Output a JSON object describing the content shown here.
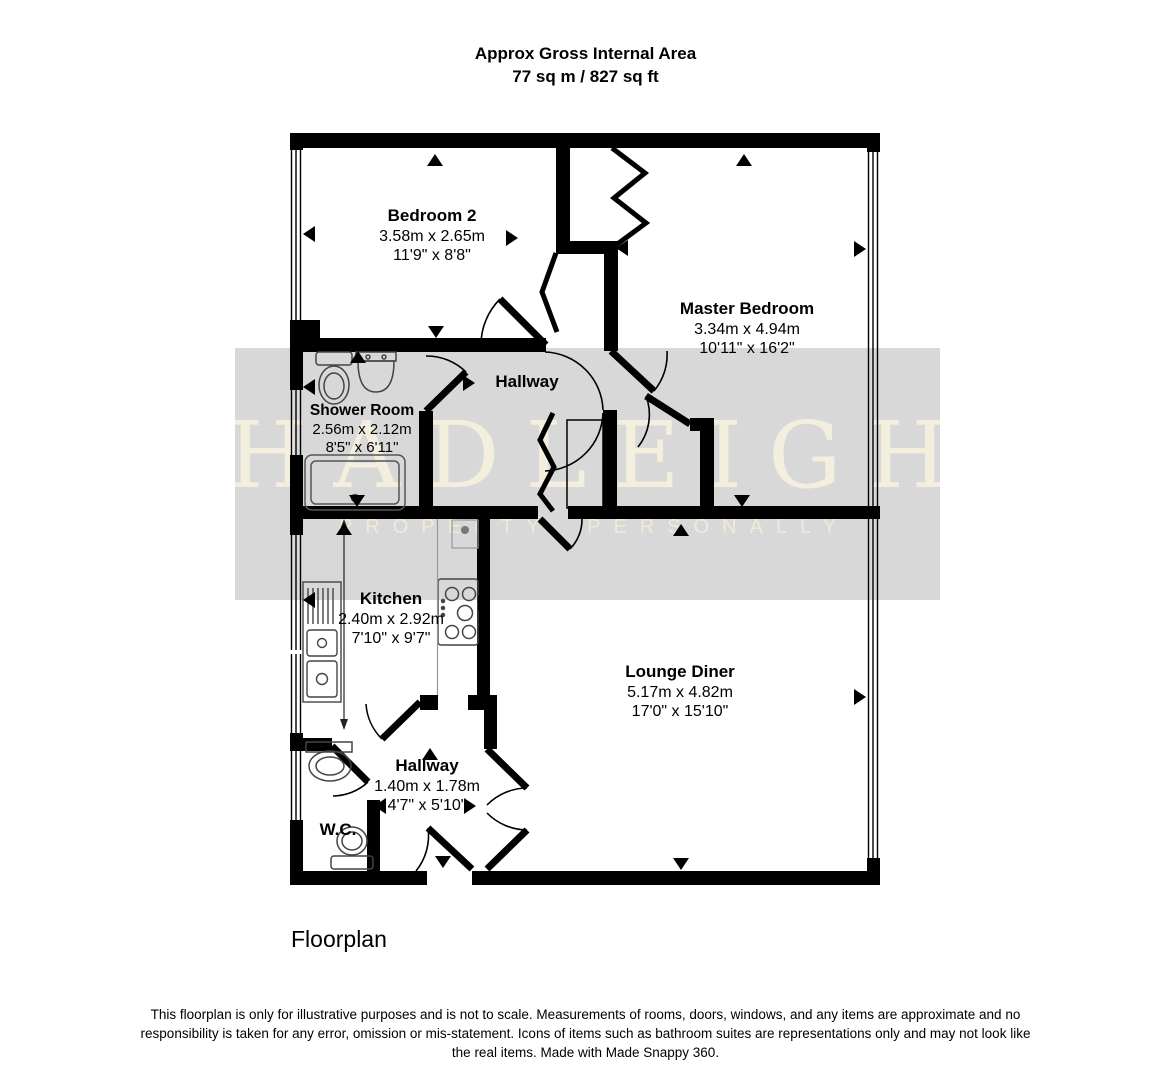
{
  "header": {
    "title_line1": "Approx Gross Internal Area",
    "title_line2": "77 sq m / 827 sq ft"
  },
  "watermark": {
    "brand": "HADLEIGH",
    "tagline": "PROPERTY. PERSONALLY",
    "band_color": "#d8d8d8",
    "text_color": "#f6efde"
  },
  "rooms": [
    {
      "id": "bedroom-2",
      "name": "Bedroom 2",
      "metric": "3.58m x 2.65m",
      "imperial": "11'9\" x 8'8\""
    },
    {
      "id": "master-bedroom",
      "name": "Master Bedroom",
      "metric": "3.34m x 4.94m",
      "imperial": "10'11\" x 16'2\""
    },
    {
      "id": "shower-room",
      "name": "Shower Room",
      "metric": "2.56m x 2.12m",
      "imperial": "8'5\" x 6'11\""
    },
    {
      "id": "hallway-upper",
      "name": "Hallway"
    },
    {
      "id": "kitchen",
      "name": "Kitchen",
      "metric": "2.40m x 2.92m",
      "imperial": "7'10\" x 9'7\""
    },
    {
      "id": "lounge-diner",
      "name": "Lounge Diner",
      "metric": "5.17m x 4.82m",
      "imperial": "17'0\" x 15'10\""
    },
    {
      "id": "hallway-lower",
      "name": "Hallway",
      "metric": "1.40m x 1.78m",
      "imperial": "4'7\" x 5'10\""
    },
    {
      "id": "wc",
      "name": "W.C."
    }
  ],
  "icons": {
    "direction_marker": "filled-triangle",
    "toilet": "toilet-outline",
    "basin": "basin-outline",
    "shower_tray": "rounded-rect-with-drain",
    "kitchen_sink": "sink-with-drainer",
    "hob": "four-burner-hob",
    "door": "quarter-circle-swing",
    "bifold_door": "zigzag",
    "window": "triple-line"
  },
  "caption": "Floorplan",
  "footer": {
    "disclaimer": "This floorplan is only for illustrative purposes and is not to scale. Measurements of rooms, doors, windows, and any items are approximate and no responsibility is taken for any error, omission or mis-statement. Icons of items such as bathroom suites are representations only and may not look like the real items. Made with Made Snappy 360."
  },
  "colors": {
    "walls": "#000000",
    "band": "#d8d8d8"
  }
}
